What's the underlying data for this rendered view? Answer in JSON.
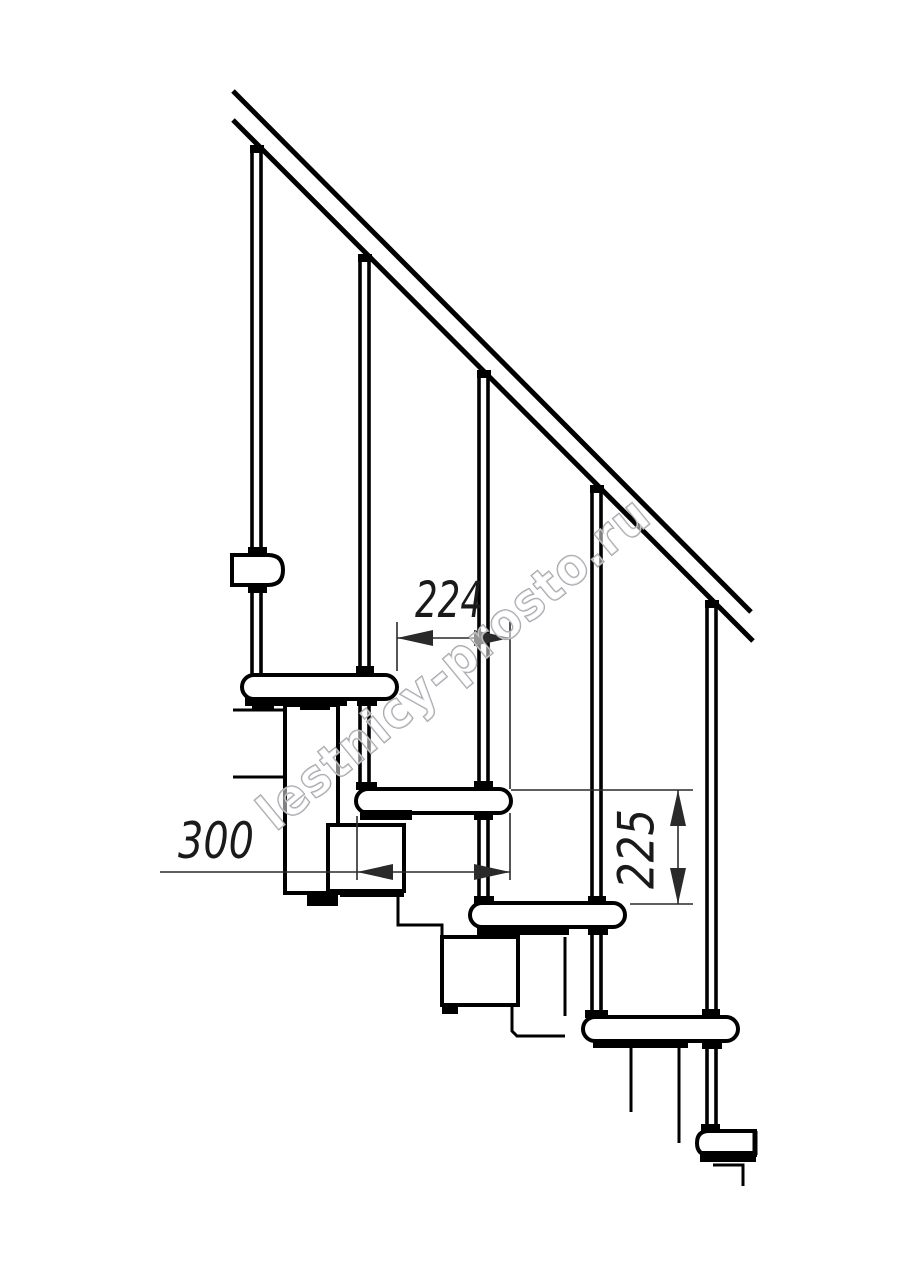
{
  "drawing": {
    "background": "#ffffff",
    "ink_color": "#000000",
    "dim_color": "#2a2a2a",
    "watermark": {
      "text": "lestnicy-prosto.ru",
      "outline_color": "#9e9ea4"
    },
    "dims": {
      "run": "224",
      "depth": "300",
      "rise": "225"
    }
  }
}
